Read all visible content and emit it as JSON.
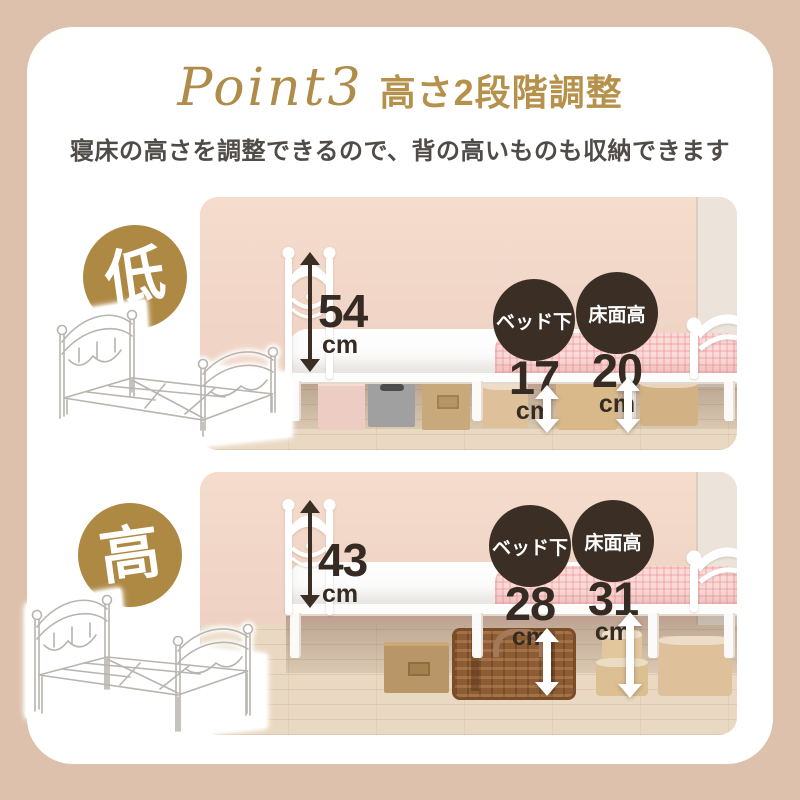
{
  "header": {
    "point_label": "Point3",
    "title": "高さ2段階調整",
    "subtitle": "寝床の高さを調整できるので、背の高いものも収納できます"
  },
  "colors": {
    "gold": "#ae8944",
    "dark_badge": "#3a2e25",
    "title_gold": "#b5914b",
    "outer_background": "#dec1ac",
    "wall_pink": "#f3d8ca"
  },
  "sections": [
    {
      "badge": "低",
      "height": {
        "value": "54",
        "unit": "cm"
      },
      "metrics": [
        {
          "label": "ベッド下",
          "value": "17",
          "unit": "cm"
        },
        {
          "label": "床面高",
          "value": "20",
          "unit": "cm"
        }
      ]
    },
    {
      "badge": "高",
      "height": {
        "value": "43",
        "unit": "cm"
      },
      "metrics": [
        {
          "label": "ベッド下",
          "value": "28",
          "unit": "cm"
        },
        {
          "label": "床面高",
          "value": "31",
          "unit": "cm"
        }
      ]
    }
  ]
}
